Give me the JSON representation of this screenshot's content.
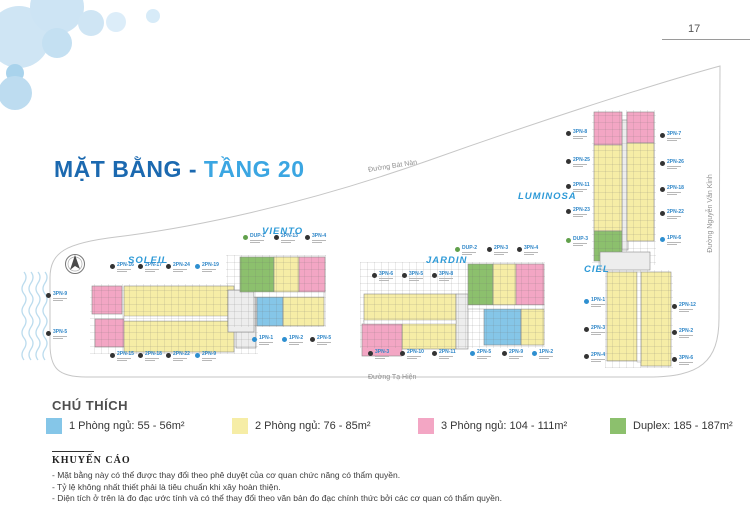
{
  "page_number": "17",
  "title": {
    "part1": "MẶT BẰNG - ",
    "part2": "TẦNG 20"
  },
  "streets": {
    "top": "Đường Bát Nàn",
    "right": "Đường Nguyễn Văn Kỉnh",
    "bottom": "Đường Tạ Hiện"
  },
  "buildings": {
    "soleil": "SOLEIL",
    "viento": "VIENTO",
    "jardin": "JARDIN",
    "luminosa": "LUMINOSA",
    "ciel": "CIEL"
  },
  "colors": {
    "one_bed": "#85c6e8",
    "two_bed": "#f6eda6",
    "three_bed": "#f3a6c4",
    "duplex": "#8cc06d",
    "badge": {
      "dark": "#333333",
      "blue": "#2e8fd0",
      "green": "#61a04b"
    }
  },
  "plan": {
    "callouts": [
      {
        "code": "2PN-16",
        "x": 110,
        "y": 263,
        "badge": "dark"
      },
      {
        "code": "2PN-17",
        "x": 138,
        "y": 263,
        "badge": "dark"
      },
      {
        "code": "2PN-24",
        "x": 166,
        "y": 263,
        "badge": "dark"
      },
      {
        "code": "2PN-19",
        "x": 195,
        "y": 263,
        "badge": "blue"
      },
      {
        "code": "3PN-9",
        "x": 46,
        "y": 292,
        "badge": "dark"
      },
      {
        "code": "3PN-5",
        "x": 46,
        "y": 330,
        "badge": "dark"
      },
      {
        "code": "2PN-15",
        "x": 110,
        "y": 352,
        "badge": "dark"
      },
      {
        "code": "2PN-18",
        "x": 138,
        "y": 352,
        "badge": "dark"
      },
      {
        "code": "2PN-22",
        "x": 166,
        "y": 352,
        "badge": "dark"
      },
      {
        "code": "2PN-9",
        "x": 195,
        "y": 352,
        "badge": "blue"
      },
      {
        "code": "DUP-1",
        "x": 243,
        "y": 234,
        "badge": "green"
      },
      {
        "code": "2PN-13",
        "x": 274,
        "y": 234,
        "badge": "dark"
      },
      {
        "code": "3PN-4",
        "x": 305,
        "y": 234,
        "badge": "dark"
      },
      {
        "code": "1PN-1",
        "x": 252,
        "y": 336,
        "badge": "blue"
      },
      {
        "code": "1PN-2",
        "x": 282,
        "y": 336,
        "badge": "blue"
      },
      {
        "code": "2PN-5",
        "x": 310,
        "y": 336,
        "badge": "dark"
      },
      {
        "code": "3PN-6",
        "x": 372,
        "y": 272,
        "badge": "dark"
      },
      {
        "code": "3PN-5",
        "x": 402,
        "y": 272,
        "badge": "dark"
      },
      {
        "code": "3PN-8",
        "x": 432,
        "y": 272,
        "badge": "dark"
      },
      {
        "code": "3PN-3",
        "x": 368,
        "y": 350,
        "badge": "dark"
      },
      {
        "code": "2PN-10",
        "x": 400,
        "y": 350,
        "badge": "dark"
      },
      {
        "code": "2PN-11",
        "x": 432,
        "y": 350,
        "badge": "dark"
      },
      {
        "code": "DUP-2",
        "x": 455,
        "y": 246,
        "badge": "green"
      },
      {
        "code": "2PN-3",
        "x": 487,
        "y": 246,
        "badge": "dark"
      },
      {
        "code": "3PN-4",
        "x": 517,
        "y": 246,
        "badge": "dark"
      },
      {
        "code": "2PN-5",
        "x": 470,
        "y": 350,
        "badge": "blue"
      },
      {
        "code": "2PN-9",
        "x": 502,
        "y": 350,
        "badge": "dark"
      },
      {
        "code": "1PN-2",
        "x": 532,
        "y": 350,
        "badge": "blue"
      },
      {
        "code": "3PN-8",
        "x": 566,
        "y": 130,
        "badge": "dark"
      },
      {
        "code": "2PN-25",
        "x": 566,
        "y": 158,
        "badge": "dark"
      },
      {
        "code": "2PN-11",
        "x": 566,
        "y": 183,
        "badge": "dark"
      },
      {
        "code": "2PN-23",
        "x": 566,
        "y": 208,
        "badge": "dark"
      },
      {
        "code": "DUP-3",
        "x": 566,
        "y": 237,
        "badge": "green"
      },
      {
        "code": "3PN-7",
        "x": 660,
        "y": 132,
        "badge": "dark"
      },
      {
        "code": "2PN-26",
        "x": 660,
        "y": 160,
        "badge": "dark"
      },
      {
        "code": "2PN-18",
        "x": 660,
        "y": 186,
        "badge": "dark"
      },
      {
        "code": "2PN-22",
        "x": 660,
        "y": 210,
        "badge": "dark"
      },
      {
        "code": "1PN-6",
        "x": 660,
        "y": 236,
        "badge": "blue"
      },
      {
        "code": "1PN-1",
        "x": 584,
        "y": 298,
        "badge": "blue"
      },
      {
        "code": "2PN-3",
        "x": 584,
        "y": 326,
        "badge": "dark"
      },
      {
        "code": "2PN-4",
        "x": 584,
        "y": 353,
        "badge": "dark"
      },
      {
        "code": "2PN-12",
        "x": 672,
        "y": 303,
        "badge": "dark"
      },
      {
        "code": "2PN-2",
        "x": 672,
        "y": 329,
        "badge": "dark"
      },
      {
        "code": "3PN-6",
        "x": 672,
        "y": 356,
        "badge": "dark"
      }
    ]
  },
  "legend": {
    "heading": "CHÚ THÍCH",
    "items": [
      {
        "label": "1 Phòng ngủ: 55 - 56m²",
        "color": "#85c6e8"
      },
      {
        "label": "2 Phòng ngủ: 76 - 85m²",
        "color": "#f6eda6"
      },
      {
        "label": "3 Phòng ngủ: 104 - 111m²",
        "color": "#f3a6c4"
      },
      {
        "label": "Duplex: 185 - 187m²",
        "color": "#8cc06d"
      }
    ]
  },
  "advisory": {
    "heading": "KHUYẾN CÁO",
    "lines": [
      "- Mặt bằng này có thể được thay đổi theo phê duyệt của cơ quan chức năng có thẩm quyền.",
      "- Tỷ lệ không nhất thiết phải là tiêu chuẩn khi xây hoàn thiện.",
      "- Diện tích ở trên là đo đạc ước tính và có thể thay đổi theo văn bản đo đạc chính thức bởi các cơ quan có thẩm quyền."
    ]
  }
}
